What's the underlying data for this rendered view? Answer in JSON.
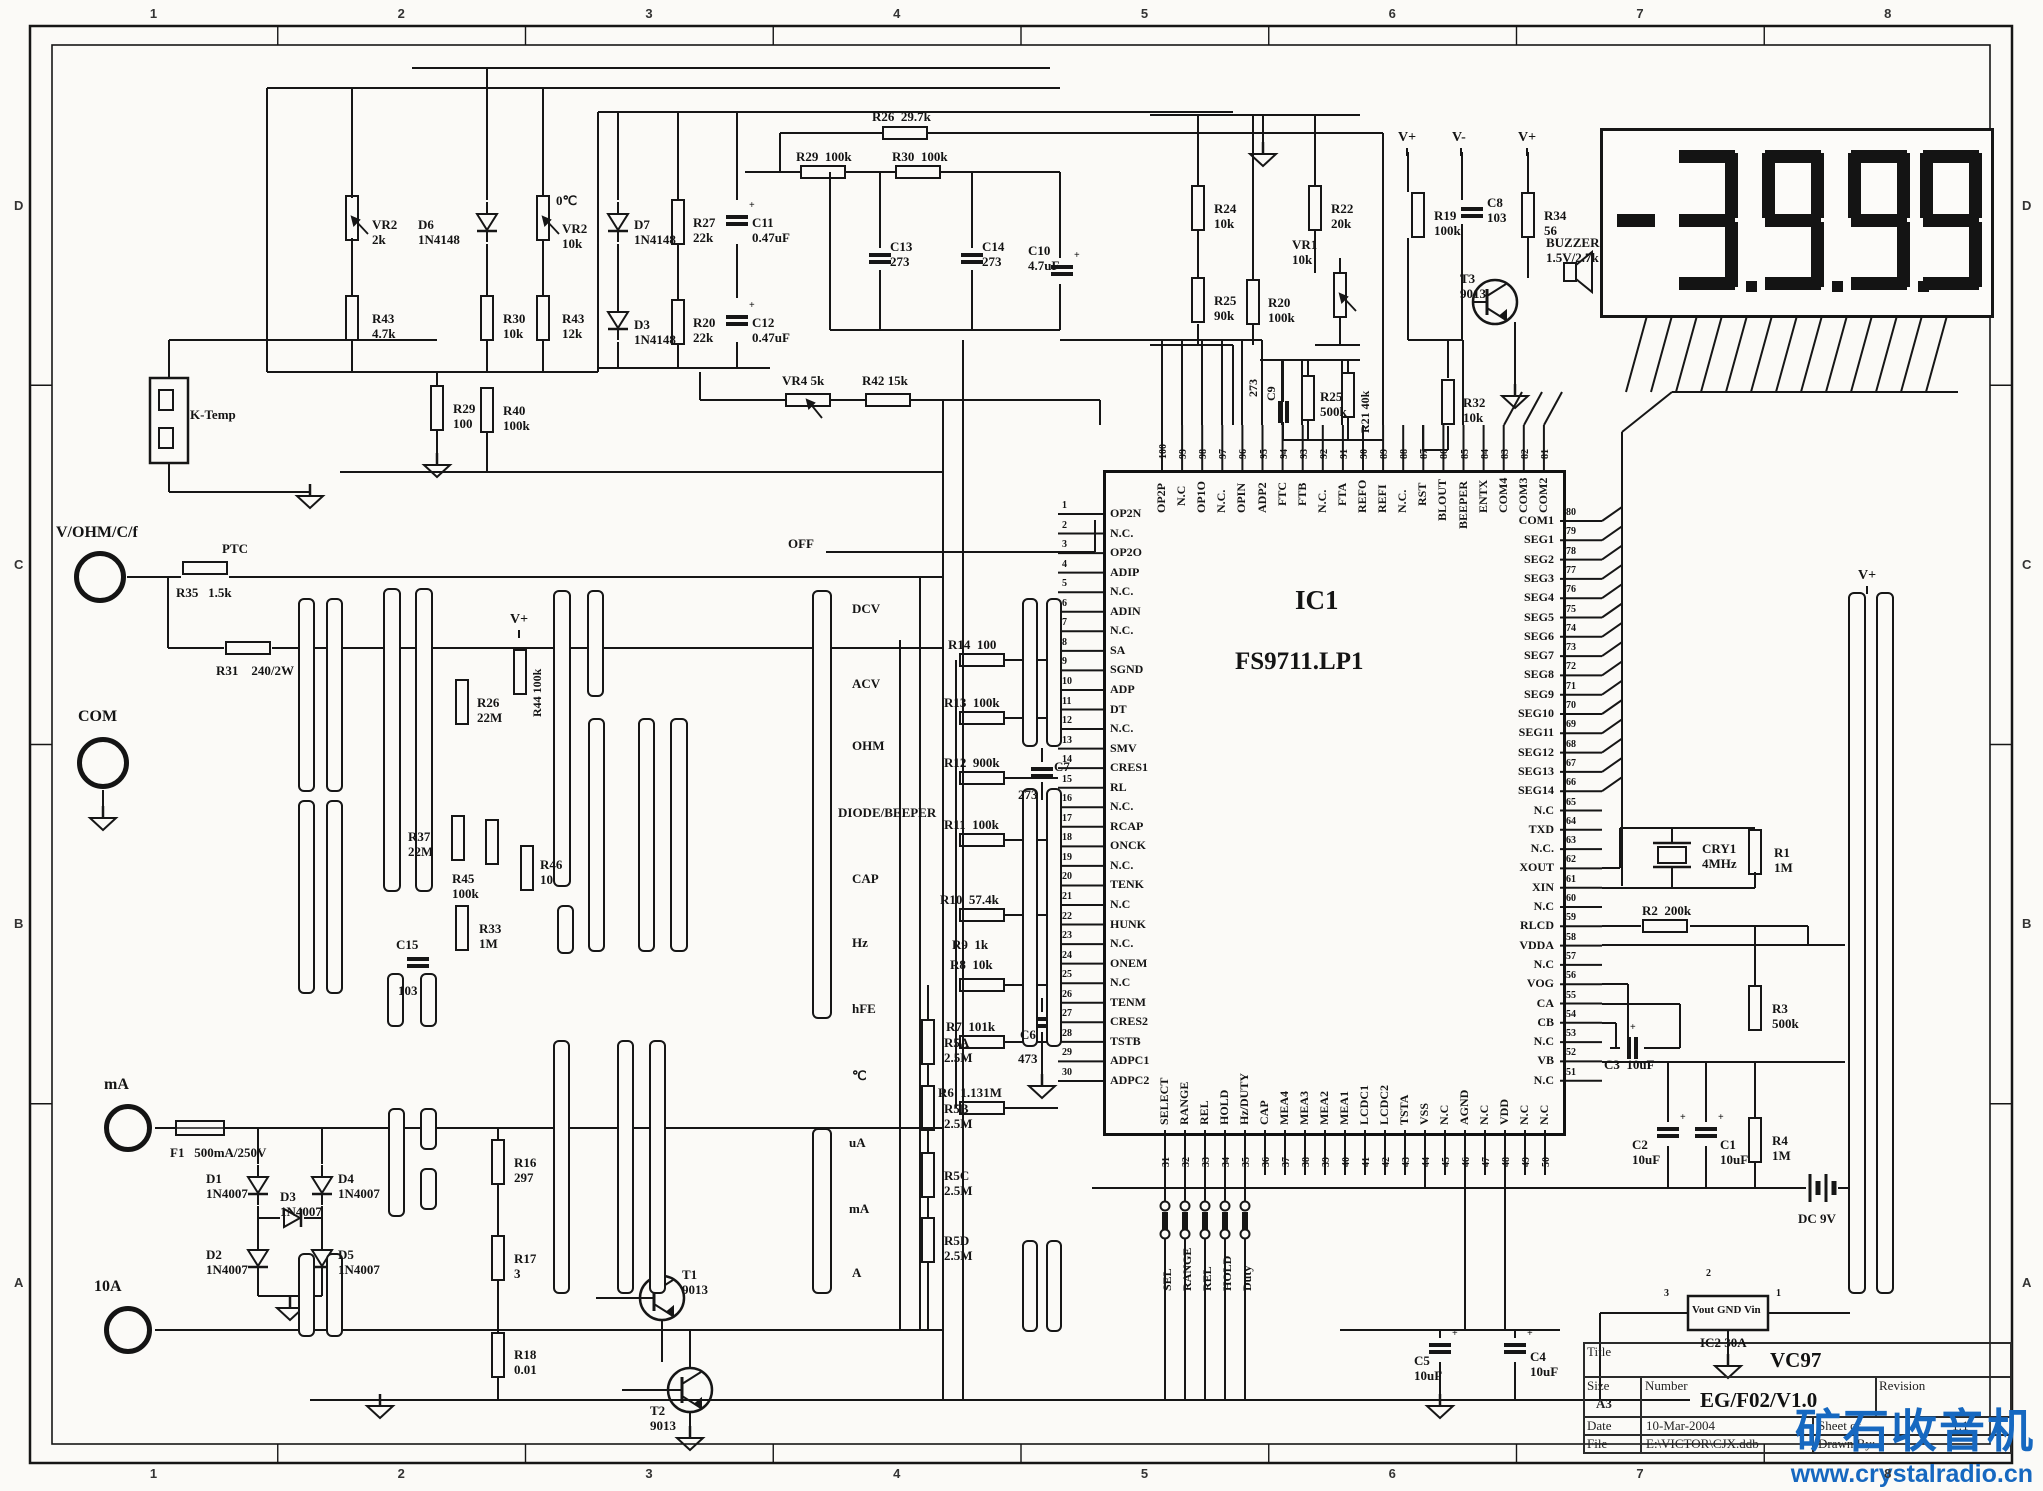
{
  "border": {
    "cols": [
      "1",
      "2",
      "3",
      "4",
      "5",
      "6",
      "7",
      "8"
    ],
    "rows": [
      "D",
      "C",
      "B",
      "A"
    ]
  },
  "display": {
    "value": "-3999",
    "dots": 3
  },
  "ic1": {
    "ref": "IC1",
    "part": "FS9711.LP1",
    "left_pins": [
      [
        1,
        "OP2N"
      ],
      [
        2,
        "N.C."
      ],
      [
        3,
        "OP2O"
      ],
      [
        4,
        "ADIP"
      ],
      [
        5,
        "N.C."
      ],
      [
        6,
        "ADIN"
      ],
      [
        7,
        "N.C."
      ],
      [
        8,
        "SA"
      ],
      [
        9,
        "SGND"
      ],
      [
        10,
        "ADP"
      ],
      [
        11,
        "DT"
      ],
      [
        12,
        "N.C."
      ],
      [
        13,
        "SMV"
      ],
      [
        14,
        "CRES1"
      ],
      [
        15,
        "RL"
      ],
      [
        16,
        "N.C."
      ],
      [
        17,
        "RCAP"
      ],
      [
        18,
        "ONCK"
      ],
      [
        19,
        "N.C."
      ],
      [
        20,
        "TENK"
      ],
      [
        21,
        "N.C"
      ],
      [
        22,
        "HUNK"
      ],
      [
        23,
        "N.C."
      ],
      [
        24,
        "ONEM"
      ],
      [
        25,
        "N.C"
      ],
      [
        26,
        "TENM"
      ],
      [
        27,
        "CRES2"
      ],
      [
        28,
        "TSTB"
      ],
      [
        29,
        "ADPC1"
      ],
      [
        30,
        "ADPC2"
      ]
    ],
    "top_pins": [
      [
        100,
        "OP2P"
      ],
      [
        99,
        "N.C"
      ],
      [
        98,
        "OP1O"
      ],
      [
        97,
        "N.C."
      ],
      [
        96,
        "OPIN"
      ],
      [
        95,
        "ADP2"
      ],
      [
        94,
        "FTC"
      ],
      [
        93,
        "FTB"
      ],
      [
        92,
        "N.C."
      ],
      [
        91,
        "FTA"
      ],
      [
        90,
        "REFO"
      ],
      [
        89,
        "REFI"
      ],
      [
        88,
        "N.C."
      ],
      [
        87,
        "RST"
      ],
      [
        86,
        "BLOUT"
      ],
      [
        85,
        "BEEPER"
      ],
      [
        84,
        "ENTX"
      ],
      [
        83,
        "COM4"
      ],
      [
        82,
        "COM3"
      ],
      [
        81,
        "COM2"
      ]
    ],
    "right_pins": [
      [
        80,
        "COM1"
      ],
      [
        79,
        "SEG1"
      ],
      [
        78,
        "SEG2"
      ],
      [
        77,
        "SEG3"
      ],
      [
        76,
        "SEG4"
      ],
      [
        75,
        "SEG5"
      ],
      [
        74,
        "SEG6"
      ],
      [
        73,
        "SEG7"
      ],
      [
        72,
        "SEG8"
      ],
      [
        71,
        "SEG9"
      ],
      [
        70,
        "SEG10"
      ],
      [
        69,
        "SEG11"
      ],
      [
        68,
        "SEG12"
      ],
      [
        67,
        "SEG13"
      ],
      [
        66,
        "SEG14"
      ],
      [
        65,
        "N.C"
      ],
      [
        64,
        "TXD"
      ],
      [
        63,
        "N.C."
      ],
      [
        62,
        "XOUT"
      ],
      [
        61,
        "XIN"
      ],
      [
        60,
        "N.C"
      ],
      [
        59,
        "RLCD"
      ],
      [
        58,
        "VDDA"
      ],
      [
        57,
        "N.C"
      ],
      [
        56,
        "VOG"
      ],
      [
        55,
        "CA"
      ],
      [
        54,
        "CB"
      ],
      [
        53,
        "N.C"
      ],
      [
        52,
        "VB"
      ],
      [
        51,
        "N.C"
      ]
    ],
    "bottom_pins": [
      [
        31,
        "SELECT"
      ],
      [
        32,
        "RANGE"
      ],
      [
        33,
        "REL"
      ],
      [
        34,
        "HOLD"
      ],
      [
        35,
        "Hz/DUTY"
      ],
      [
        36,
        "CAP"
      ],
      [
        37,
        "MEA4"
      ],
      [
        38,
        "MEA3"
      ],
      [
        39,
        "MEA2"
      ],
      [
        40,
        "MEA1"
      ],
      [
        41,
        "LCDC1"
      ],
      [
        42,
        "LCDC2"
      ],
      [
        43,
        "TSTA"
      ],
      [
        44,
        "VSS"
      ],
      [
        45,
        "N.C"
      ],
      [
        46,
        "AGND"
      ],
      [
        47,
        "N.C"
      ],
      [
        48,
        "VDD"
      ],
      [
        49,
        "N.C"
      ],
      [
        50,
        "N.C"
      ]
    ]
  },
  "terminals": [
    {
      "label": "V/OHM/C/f"
    },
    {
      "label": "COM"
    },
    {
      "label": "mA"
    },
    {
      "label": "10A"
    }
  ],
  "modes": [
    "OFF",
    "DCV",
    "ACV",
    "OHM",
    "DIODE/BEEPER",
    "CAP",
    "Hz",
    "hFE",
    "℃",
    "uA",
    "mA",
    "A"
  ],
  "buttons": [
    "SEL",
    "RANGE",
    "REL",
    "HOLD",
    "Duty"
  ],
  "ic2": {
    "ref": "IC2 30A",
    "pins": [
      "Vout",
      "GND",
      "Vin"
    ],
    "pin_nums": [
      "3",
      "2",
      "1"
    ]
  },
  "title_block": {
    "title_label": "Title",
    "title": "VC97",
    "size_label": "Size",
    "size": "A3",
    "number_label": "Number",
    "number": "EG/F02/V1.0",
    "revision_label": "Revision",
    "date_label": "Date",
    "date": "10-Mar-2004",
    "sheet_label": "Sheet   of",
    "sheet": "1:1",
    "file_label": "File",
    "file": "E:\\VICTOR\\CJX.ddb",
    "drawn_label": "Drawn By:"
  },
  "watermark": {
    "line1": "矿石收音机",
    "line2": "www.crystalradio.cn",
    "color": "#1668c0"
  },
  "components": [
    {
      "t": "pot-v",
      "x": 352,
      "y": 218,
      "r": "VR2",
      "v": "2k",
      "lx": 372,
      "ly": 218
    },
    {
      "t": "res-v",
      "x": 352,
      "y": 318,
      "r": "R43",
      "v": "4.7k",
      "lx": 372,
      "ly": 312
    },
    {
      "t": "diode-v",
      "x": 487,
      "y": 222,
      "r": "D6",
      "v": "1N4148",
      "lx": 418,
      "ly": 218
    },
    {
      "t": "res-v",
      "x": 487,
      "y": 318,
      "r": "R30",
      "v": "10k",
      "lx": 503,
      "ly": 312
    },
    {
      "t": "pot-v",
      "x": 543,
      "y": 218,
      "r": "VR2",
      "v": "10k",
      "lx": 562,
      "ly": 222
    },
    {
      "t": "text",
      "x": 556,
      "y": 194,
      "r": "0℃"
    },
    {
      "t": "res-v",
      "x": 543,
      "y": 318,
      "r": "R43",
      "v": "12k",
      "lx": 562,
      "ly": 312
    },
    {
      "t": "res-v",
      "x": 437,
      "y": 408,
      "r": "R29",
      "v": "100",
      "lx": 453,
      "ly": 402
    },
    {
      "t": "res-v",
      "x": 487,
      "y": 410,
      "r": "R40",
      "v": "100k",
      "lx": 503,
      "ly": 404
    },
    {
      "t": "box",
      "x": 150,
      "y": 378,
      "w": 38,
      "h": 85,
      "r": "K-Temp",
      "lx": 190,
      "ly": 408
    },
    {
      "t": "diode-v",
      "x": 618,
      "y": 222,
      "r": "D7",
      "v": "1N4148",
      "lx": 634,
      "ly": 218
    },
    {
      "t": "res-v",
      "x": 678,
      "y": 222,
      "r": "R27",
      "v": "22k",
      "lx": 693,
      "ly": 216
    },
    {
      "t": "cap-v",
      "x": 737,
      "y": 220,
      "plus": 1,
      "r": "C11",
      "v": "0.47uF",
      "lx": 752,
      "ly": 216
    },
    {
      "t": "diode-v",
      "x": 618,
      "y": 320,
      "r": "D3",
      "v": "1N4148",
      "lx": 634,
      "ly": 318
    },
    {
      "t": "res-v",
      "x": 678,
      "y": 322,
      "r": "R20",
      "v": "22k",
      "lx": 693,
      "ly": 316
    },
    {
      "t": "cap-v",
      "x": 737,
      "y": 320,
      "plus": 1,
      "r": "C12",
      "v": "0.47uF",
      "lx": 752,
      "ly": 316
    },
    {
      "t": "res-h",
      "x": 905,
      "y": 133,
      "r": "R26  29.7k",
      "lx": 872,
      "ly": 110
    },
    {
      "t": "res-h",
      "x": 823,
      "y": 172,
      "r": "R29  100k",
      "lx": 796,
      "ly": 150
    },
    {
      "t": "res-h",
      "x": 918,
      "y": 172,
      "r": "R30  100k",
      "lx": 892,
      "ly": 150
    },
    {
      "t": "cap-v",
      "x": 880,
      "y": 258,
      "r": "C13",
      "v": "273",
      "lx": 890,
      "ly": 240
    },
    {
      "t": "cap-v",
      "x": 972,
      "y": 258,
      "r": "C14",
      "v": "273",
      "lx": 982,
      "ly": 240
    },
    {
      "t": "cap-v",
      "x": 1062,
      "y": 270,
      "plus": 1,
      "r": "C10",
      "v": "4.7uF",
      "lx": 1028,
      "ly": 244
    },
    {
      "t": "pot-h",
      "x": 808,
      "y": 400,
      "r": "VR4 5k",
      "lx": 782,
      "ly": 374
    },
    {
      "t": "res-h",
      "x": 888,
      "y": 400,
      "r": "R42 15k",
      "lx": 862,
      "ly": 374
    },
    {
      "t": "res-v",
      "x": 1198,
      "y": 208,
      "r": "R24",
      "v": "10k",
      "lx": 1214,
      "ly": 202
    },
    {
      "t": "res-v",
      "x": 1198,
      "y": 300,
      "r": "R25",
      "v": "90k",
      "lx": 1214,
      "ly": 294
    },
    {
      "t": "res-v",
      "x": 1253,
      "y": 302,
      "r": "R20",
      "v": "100k",
      "lx": 1268,
      "ly": 296
    },
    {
      "t": "res-v",
      "x": 1315,
      "y": 208,
      "r": "R22",
      "v": "20k",
      "lx": 1331,
      "ly": 202
    },
    {
      "t": "pot-v",
      "x": 1340,
      "y": 295,
      "r": "VR1",
      "v": "10k",
      "lx": 1292,
      "ly": 238
    },
    {
      "t": "vtext",
      "x": 1272,
      "y": 400,
      "r": "C9"
    },
    {
      "t": "vtext",
      "x": 1254,
      "y": 396,
      "r": "273"
    },
    {
      "t": "cap-h",
      "x": 1283,
      "y": 412
    },
    {
      "t": "res-v",
      "x": 1308,
      "y": 398,
      "r": "R25",
      "v": "500k",
      "lx": 1320,
      "ly": 390
    },
    {
      "t": "res-v",
      "x": 1348,
      "y": 395
    },
    {
      "t": "vtext",
      "x": 1366,
      "y": 432,
      "r": "R21 40k"
    },
    {
      "t": "res-v",
      "x": 1418,
      "y": 215,
      "r": "R19",
      "v": "100k",
      "lx": 1434,
      "ly": 209
    },
    {
      "t": "cap-v",
      "x": 1472,
      "y": 212,
      "r": "C8",
      "v": "103",
      "lx": 1487,
      "ly": 196
    },
    {
      "t": "res-v",
      "x": 1528,
      "y": 215,
      "r": "R34",
      "v": "56",
      "lx": 1544,
      "ly": 209
    },
    {
      "t": "vplus",
      "x": 1408,
      "y": 140,
      "r": "V+"
    },
    {
      "t": "vplus",
      "x": 1462,
      "y": 140,
      "r": "V-"
    },
    {
      "t": "vplus",
      "x": 1528,
      "y": 140,
      "r": "V+"
    },
    {
      "t": "buzzer",
      "x": 1580,
      "y": 272,
      "r": "BUZZER",
      "v": "1.5V/2.7k",
      "lx": 1546,
      "ly": 236
    },
    {
      "t": "transistor",
      "x": 1495,
      "y": 302,
      "r": "T3",
      "v": "9013",
      "lx": 1460,
      "ly": 272
    },
    {
      "t": "res-v",
      "x": 1448,
      "y": 402,
      "r": "R32",
      "v": "10k",
      "lx": 1463,
      "ly": 396
    },
    {
      "t": "crystal",
      "x": 1672,
      "y": 855,
      "r": "CRY1",
      "v": "4MHz",
      "lx": 1702,
      "ly": 842
    },
    {
      "t": "res-v",
      "x": 1755,
      "y": 852,
      "r": "R1",
      "v": "1M",
      "lx": 1774,
      "ly": 846
    },
    {
      "t": "res-h",
      "x": 1665,
      "y": 926,
      "r": "R2  200k",
      "lx": 1642,
      "ly": 904
    },
    {
      "t": "res-v",
      "x": 1755,
      "y": 1008,
      "r": "R3",
      "v": "500k",
      "lx": 1772,
      "ly": 1002
    },
    {
      "t": "cap-h",
      "x": 1632,
      "y": 1048,
      "plus": 1,
      "r": "C3  10uF",
      "lx": 1604,
      "ly": 1058
    },
    {
      "t": "cap-v",
      "x": 1668,
      "y": 1132,
      "plus": 1,
      "r": "C2",
      "v": "10uF",
      "lx": 1632,
      "ly": 1138
    },
    {
      "t": "cap-v",
      "x": 1706,
      "y": 1132,
      "plus": 1,
      "r": "C1",
      "v": "10uF",
      "lx": 1720,
      "ly": 1138
    },
    {
      "t": "res-v",
      "x": 1755,
      "y": 1140,
      "r": "R4",
      "v": "1M",
      "lx": 1772,
      "ly": 1134
    },
    {
      "t": "battery",
      "x": 1822,
      "y": 1188,
      "r": "DC 9V",
      "lx": 1798,
      "ly": 1212
    },
    {
      "t": "vplus",
      "x": 1868,
      "y": 578,
      "r": "V+"
    },
    {
      "t": "cap-v",
      "x": 1440,
      "y": 1348,
      "plus": 1,
      "r": "C5",
      "v": "10uF",
      "lx": 1414,
      "ly": 1354
    },
    {
      "t": "cap-v",
      "x": 1515,
      "y": 1348,
      "plus": 1,
      "r": "C4",
      "v": "10uF",
      "lx": 1530,
      "ly": 1350
    },
    {
      "t": "res-v",
      "x": 462,
      "y": 702,
      "r": "R26",
      "v": "22M",
      "lx": 477,
      "ly": 696
    },
    {
      "t": "res-v",
      "x": 520,
      "y": 672
    },
    {
      "t": "vtext",
      "x": 538,
      "y": 716,
      "r": "R44 100k"
    },
    {
      "t": "res-v",
      "x": 458,
      "y": 838,
      "r": "R37",
      "v": "22M",
      "lx": 408,
      "ly": 830
    },
    {
      "t": "res-v",
      "x": 492,
      "y": 842,
      "r": "R45",
      "v": "100k",
      "lx": 452,
      "ly": 872
    },
    {
      "t": "res-v",
      "x": 527,
      "y": 868,
      "r": "R46",
      "v": "10",
      "lx": 540,
      "ly": 858
    },
    {
      "t": "res-v",
      "x": 462,
      "y": 928,
      "r": "R33",
      "v": "1M",
      "lx": 479,
      "ly": 922
    },
    {
      "t": "cap-v",
      "x": 418,
      "y": 962
    },
    {
      "t": "text",
      "x": 396,
      "y": 938,
      "r": "C15"
    },
    {
      "t": "text",
      "x": 398,
      "y": 984,
      "r": "103"
    },
    {
      "t": "vplus",
      "x": 520,
      "y": 622,
      "r": "V+"
    },
    {
      "t": "res-h",
      "x": 205,
      "y": 568
    },
    {
      "t": "text",
      "x": 222,
      "y": 542,
      "r": "PTC"
    },
    {
      "t": "text",
      "x": 176,
      "y": 586,
      "r": "R35   1.5k"
    },
    {
      "t": "res-h",
      "x": 248,
      "y": 648
    },
    {
      "t": "text",
      "x": 216,
      "y": 664,
      "r": "R31    240/2W"
    },
    {
      "t": "fuse",
      "x": 200,
      "y": 1128
    },
    {
      "t": "text",
      "x": 170,
      "y": 1146,
      "r": "F1   500mA/250V"
    },
    {
      "t": "diode-v",
      "x": 258,
      "y": 1185,
      "r": "D1",
      "v": "1N4007",
      "lx": 206,
      "ly": 1172
    },
    {
      "t": "diode-v",
      "x": 322,
      "y": 1185,
      "r": "D4",
      "v": "1N4007",
      "lx": 338,
      "ly": 1172
    },
    {
      "t": "diode-h",
      "x": 292,
      "y": 1218,
      "r": "D3",
      "v": "1N4007",
      "lx": 280,
      "ly": 1190
    },
    {
      "t": "diode-v",
      "x": 258,
      "y": 1258,
      "r": "D2",
      "v": "1N4007",
      "lx": 206,
      "ly": 1248
    },
    {
      "t": "diode-v",
      "x": 322,
      "y": 1258,
      "r": "D5",
      "v": "1N4007",
      "lx": 338,
      "ly": 1248
    },
    {
      "t": "res-v",
      "x": 498,
      "y": 1162,
      "r": "R16",
      "v": "297",
      "lx": 514,
      "ly": 1156
    },
    {
      "t": "res-v",
      "x": 498,
      "y": 1258,
      "r": "R17",
      "v": "3",
      "lx": 514,
      "ly": 1252
    },
    {
      "t": "res-v",
      "x": 498,
      "y": 1355,
      "r": "R18",
      "v": "0.01",
      "lx": 514,
      "ly": 1348
    },
    {
      "t": "transistor",
      "x": 662,
      "y": 1298,
      "r": "T1",
      "v": "9013",
      "lx": 682,
      "ly": 1268
    },
    {
      "t": "transistor",
      "x": 690,
      "y": 1390,
      "r": "T2",
      "v": "9013",
      "lx": 650,
      "ly": 1404
    },
    {
      "t": "res-h",
      "x": 982,
      "y": 660,
      "r": "R14  100",
      "lx": 948,
      "ly": 638
    },
    {
      "t": "res-h",
      "x": 982,
      "y": 718,
      "r": "R13  100k",
      "lx": 944,
      "ly": 696
    },
    {
      "t": "res-h",
      "x": 982,
      "y": 778,
      "r": "R12  900k",
      "lx": 944,
      "ly": 756
    },
    {
      "t": "res-h",
      "x": 982,
      "y": 840,
      "r": "R11  100k",
      "lx": 944,
      "ly": 818
    },
    {
      "t": "res-h",
      "x": 982,
      "y": 915,
      "r": "R10  57.4k",
      "lx": 940,
      "ly": 893
    },
    {
      "t": "text",
      "x": 952,
      "y": 938,
      "r": "R9  1k"
    },
    {
      "t": "text",
      "x": 950,
      "y": 958,
      "r": "R8  10k"
    },
    {
      "t": "res-h",
      "x": 982,
      "y": 985
    },
    {
      "t": "res-h",
      "x": 982,
      "y": 1042,
      "r": "R7  101k",
      "lx": 946,
      "ly": 1020
    },
    {
      "t": "res-h",
      "x": 982,
      "y": 1108,
      "r": "R6  1.131M",
      "lx": 938,
      "ly": 1086
    },
    {
      "t": "cap-v",
      "x": 1042,
      "y": 772
    },
    {
      "t": "text",
      "x": 1054,
      "y": 760,
      "r": "C7"
    },
    {
      "t": "text",
      "x": 1018,
      "y": 788,
      "r": "273"
    },
    {
      "t": "cap-v",
      "x": 1042,
      "y": 1022
    },
    {
      "t": "text",
      "x": 1020,
      "y": 1028,
      "r": "C6"
    },
    {
      "t": "text",
      "x": 1018,
      "y": 1052,
      "r": "473"
    },
    {
      "t": "res-v",
      "x": 928,
      "y": 1042,
      "r": "R5A",
      "v": "2.5M",
      "lx": 944,
      "ly": 1036
    },
    {
      "t": "res-v",
      "x": 928,
      "y": 1108,
      "r": "R5B",
      "v": "2.5M",
      "lx": 944,
      "ly": 1102
    },
    {
      "t": "res-v",
      "x": 928,
      "y": 1175,
      "r": "R5C",
      "v": "2.5M",
      "lx": 944,
      "ly": 1169
    },
    {
      "t": "res-v",
      "x": 928,
      "y": 1240,
      "r": "R5D",
      "v": "2.5M",
      "lx": 944,
      "ly": 1234
    }
  ]
}
